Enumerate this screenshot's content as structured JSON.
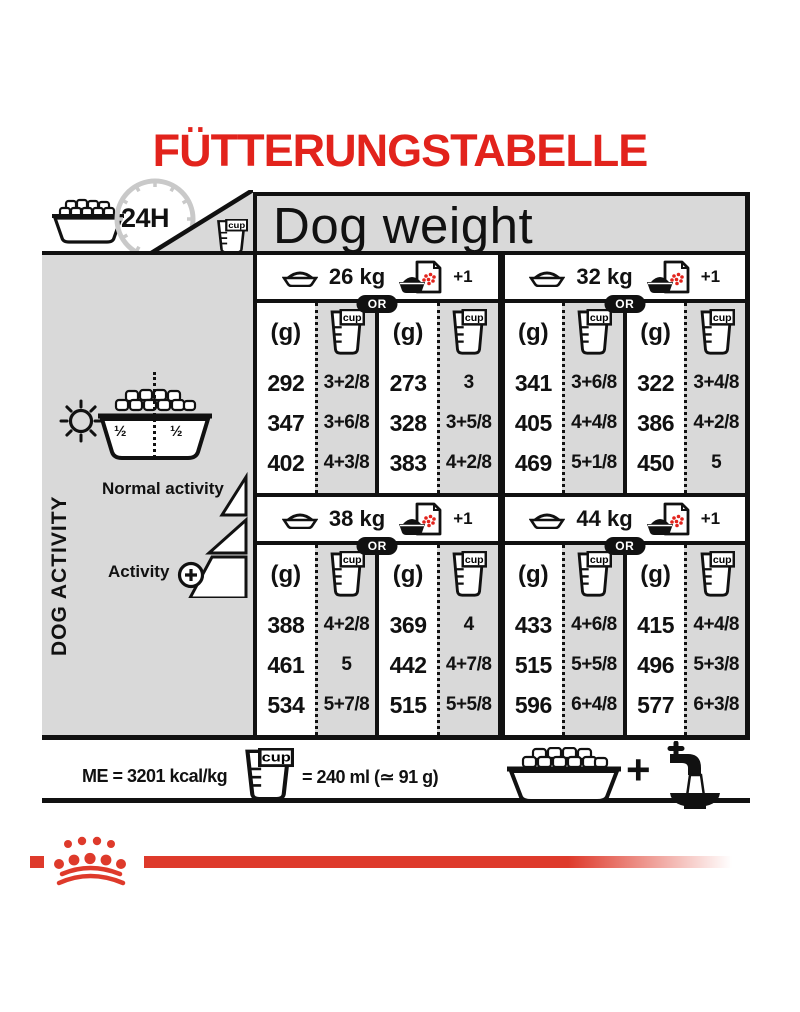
{
  "title": "FÜTTERUNGSTABELLE",
  "colors": {
    "accent_red": "#e2231c",
    "logo_red": "#de3a2b",
    "table_gray": "#d9d9d9",
    "ink": "#111111",
    "clock_gray": "#c9c9c9"
  },
  "header": {
    "clock_label": "24H",
    "dog_weight_label": "Dog weight"
  },
  "icons": {
    "cup_label": "cup"
  },
  "table": {
    "or_label": "OR",
    "plus_label": "+1",
    "grams_label": "(g)",
    "blocks": [
      {
        "halves": [
          {
            "weight": "26 kg",
            "rows": [
              [
                "292",
                "3+2/8",
                "273",
                "3"
              ],
              [
                "347",
                "3+6/8",
                "328",
                "3+5/8"
              ],
              [
                "402",
                "4+3/8",
                "383",
                "4+2/8"
              ]
            ]
          },
          {
            "weight": "32 kg",
            "rows": [
              [
                "341",
                "3+6/8",
                "322",
                "3+4/8"
              ],
              [
                "405",
                "4+4/8",
                "386",
                "4+2/8"
              ],
              [
                "469",
                "5+1/8",
                "450",
                "5"
              ]
            ]
          }
        ]
      },
      {
        "halves": [
          {
            "weight": "38 kg",
            "rows": [
              [
                "388",
                "4+2/8",
                "369",
                "4"
              ],
              [
                "461",
                "5",
                "442",
                "4+7/8"
              ],
              [
                "534",
                "5+7/8",
                "515",
                "5+5/8"
              ]
            ]
          },
          {
            "weight": "44 kg",
            "rows": [
              [
                "433",
                "4+6/8",
                "415",
                "4+4/8"
              ],
              [
                "515",
                "5+5/8",
                "496",
                "5+3/8"
              ],
              [
                "596",
                "6+4/8",
                "577",
                "6+3/8"
              ]
            ]
          }
        ]
      }
    ]
  },
  "sidebar": {
    "title": "DOG ACTIVITY",
    "bowl_half_left": "½",
    "bowl_half_right": "½",
    "normal_activity_label": "Normal activity",
    "activity_label": "Activity"
  },
  "footer": {
    "me_label": "ME = 3201 kcal/kg",
    "cup_equivalence": "= 240 ml (≃ 91 g)",
    "plus_sign": "+"
  },
  "chart_data": {
    "type": "table",
    "title": "FÜTTERUNGSTABELLE",
    "column_group_header": "Dog weight",
    "row_groups": [
      "Normal activity (low)",
      "Medium activity",
      "High activity (+)"
    ],
    "units": {
      "grams": "(g)",
      "cups": "cup",
      "cup_volume": "1 cup = 240 ml (≃ 91 g)",
      "energy_density": "ME = 3201 kcal/kg",
      "ration_period": "24H"
    },
    "weights": [
      {
        "dog_weight": "26 kg",
        "dry_only": {
          "g": [
            292,
            347,
            402
          ],
          "cups": [
            "3+2/8",
            "3+6/8",
            "4+3/8"
          ]
        },
        "dry_plus_1_pouch": {
          "g": [
            273,
            328,
            383
          ],
          "cups": [
            "3",
            "3+5/8",
            "4+2/8"
          ]
        }
      },
      {
        "dog_weight": "32 kg",
        "dry_only": {
          "g": [
            341,
            405,
            469
          ],
          "cups": [
            "3+6/8",
            "4+4/8",
            "5+1/8"
          ]
        },
        "dry_plus_1_pouch": {
          "g": [
            322,
            386,
            450
          ],
          "cups": [
            "3+4/8",
            "4+2/8",
            "5"
          ]
        }
      },
      {
        "dog_weight": "38 kg",
        "dry_only": {
          "g": [
            388,
            461,
            534
          ],
          "cups": [
            "4+2/8",
            "5",
            "5+7/8"
          ]
        },
        "dry_plus_1_pouch": {
          "g": [
            369,
            442,
            515
          ],
          "cups": [
            "4",
            "4+7/8",
            "5+5/8"
          ]
        }
      },
      {
        "dog_weight": "44 kg",
        "dry_only": {
          "g": [
            433,
            515,
            596
          ],
          "cups": [
            "4+6/8",
            "5+5/8",
            "6+4/8"
          ]
        },
        "dry_plus_1_pouch": {
          "g": [
            415,
            496,
            577
          ],
          "cups": [
            "4+4/8",
            "5+3/8",
            "6+3/8"
          ]
        }
      }
    ]
  }
}
